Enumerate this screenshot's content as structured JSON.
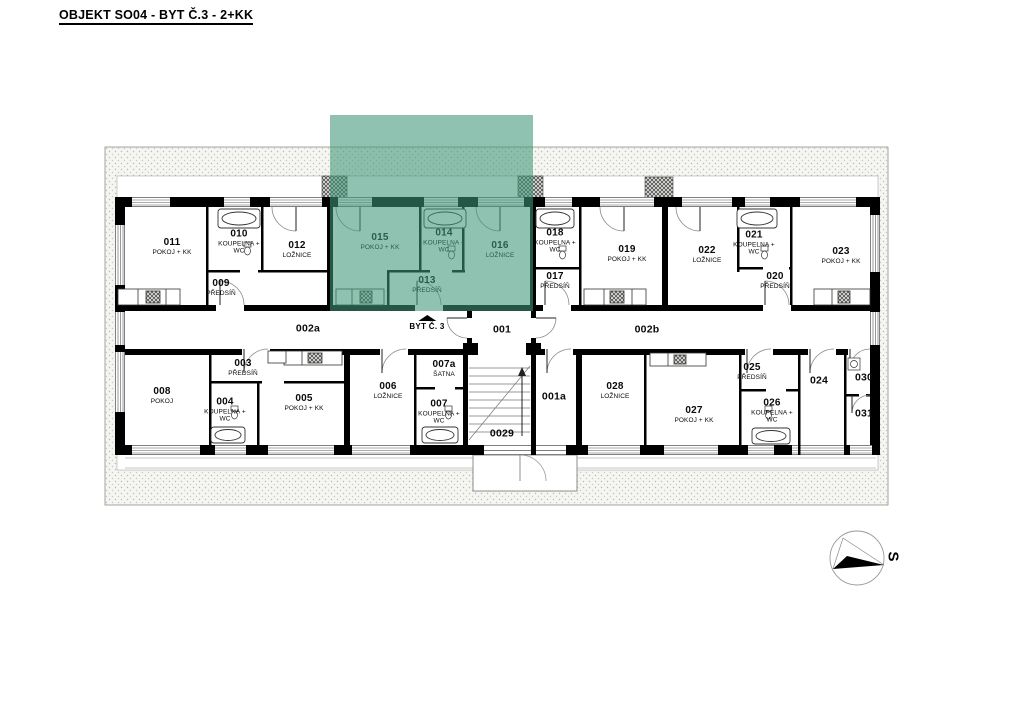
{
  "title": "OBJEKT SO04 - BYT Č.3 - 2+KK",
  "highlight": {
    "color": "#409678",
    "label": "BYT Č. 3",
    "arrow_icon": "triangle-up"
  },
  "compass": {
    "label": "S",
    "icon": "north-arrow"
  },
  "rooms": [
    {
      "number": "011",
      "name": "POKOJ + KK"
    },
    {
      "number": "010",
      "name": "KOUPELNA + WC"
    },
    {
      "number": "012",
      "name": "LOŽNICE"
    },
    {
      "number": "009",
      "name": "PŘEDSÍŇ"
    },
    {
      "number": "015",
      "name": "POKOJ + KK"
    },
    {
      "number": "014",
      "name": "KOUPELNA + WC"
    },
    {
      "number": "013",
      "name": "PŘEDSÍŇ"
    },
    {
      "number": "016",
      "name": "LOŽNICE"
    },
    {
      "number": "018",
      "name": "KOUPELNA + WC"
    },
    {
      "number": "017",
      "name": "PŘEDSÍŇ"
    },
    {
      "number": "019",
      "name": "POKOJ + KK"
    },
    {
      "number": "022",
      "name": "LOŽNICE"
    },
    {
      "number": "021",
      "name": "KOUPELNA + WC"
    },
    {
      "number": "020",
      "name": "PŘEDSÍŇ"
    },
    {
      "number": "023",
      "name": "POKOJ + KK"
    },
    {
      "number": "002a",
      "name": ""
    },
    {
      "number": "001",
      "name": ""
    },
    {
      "number": "002b",
      "name": ""
    },
    {
      "number": "003",
      "name": "PŘEDSÍŇ"
    },
    {
      "number": "008",
      "name": "POKOJ"
    },
    {
      "number": "004",
      "name": "KOUPELNA + WC"
    },
    {
      "number": "005",
      "name": "POKOJ + KK"
    },
    {
      "number": "006",
      "name": "LOŽNICE"
    },
    {
      "number": "007a",
      "name": "ŠATNA"
    },
    {
      "number": "007",
      "name": "KOUPELNA + WC"
    },
    {
      "number": "0029",
      "name": ""
    },
    {
      "number": "001a",
      "name": ""
    },
    {
      "number": "028",
      "name": "LOŽNICE"
    },
    {
      "number": "027",
      "name": "POKOJ + KK"
    },
    {
      "number": "025",
      "name": "PŘEDSÍŇ"
    },
    {
      "number": "026",
      "name": "KOUPELNA + WC"
    },
    {
      "number": "024",
      "name": ""
    },
    {
      "number": "030",
      "name": ""
    },
    {
      "number": "031",
      "name": ""
    }
  ]
}
